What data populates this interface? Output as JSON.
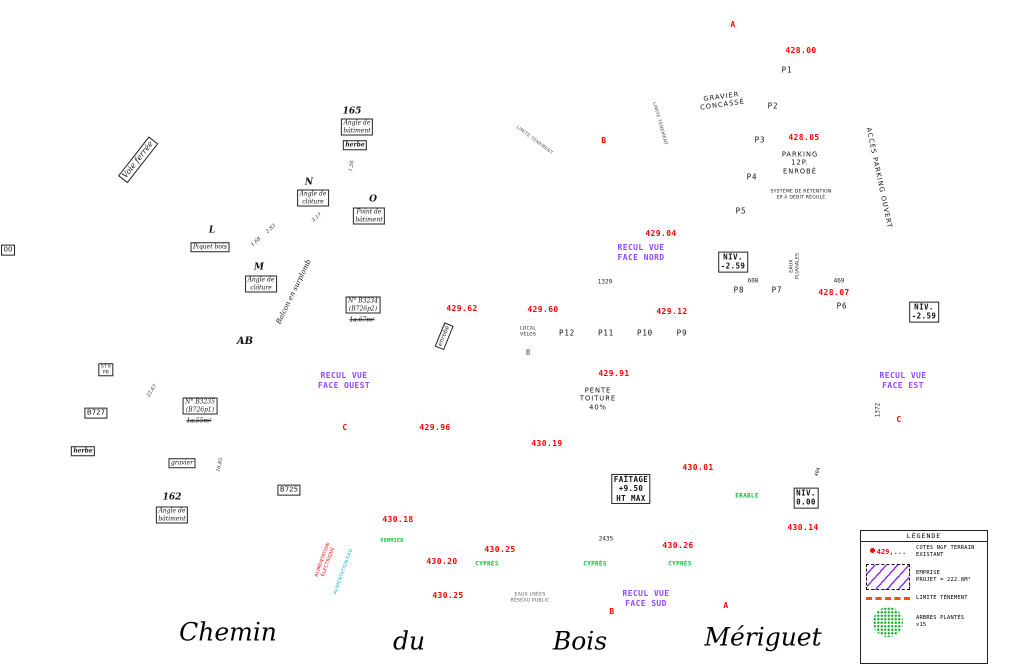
{
  "streets": {
    "chemin": "Chemin",
    "du": "du",
    "bois": "Bois",
    "meriguet": "Mériguet"
  },
  "legend": {
    "title": "LÉGENDE",
    "cote_sample": "429,...",
    "items": [
      {
        "text": "COTES NGF TERRAIN\nEXISTANT"
      },
      {
        "text": "EMPRISE\nPROJET = 222.8M²"
      },
      {
        "text": "LIMITE TÈNEMENT"
      },
      {
        "text": "ARBRES PLANTÉS\nx15"
      }
    ]
  },
  "building": {
    "ridge_label": "FAÎTAGE\n+9.50\nHT MAX",
    "slope_label": "PENTE\nTOITURE\n40%",
    "emprise_area": "222.8M²"
  },
  "elevations": [
    {
      "v": "428.00",
      "x": 801,
      "y": 51,
      "dx": 779,
      "dy": 51
    },
    {
      "v": "428.05",
      "x": 804,
      "y": 138,
      "dx": 781,
      "dy": 138
    },
    {
      "v": "429.04",
      "x": 661,
      "y": 234,
      "dx": 640,
      "dy": 234
    },
    {
      "v": "429.62",
      "x": 462,
      "y": 309,
      "dx": 482,
      "dy": 313
    },
    {
      "v": "429.60",
      "x": 543,
      "y": 310,
      "dx": 565,
      "dy": 313
    },
    {
      "v": "429.12",
      "x": 672,
      "y": 312,
      "dx": 695,
      "dy": 314
    },
    {
      "v": "428.07",
      "x": 834,
      "y": 293,
      "dx": 810,
      "dy": 294
    },
    {
      "v": "429.96",
      "x": 435,
      "y": 428,
      "dx": 453,
      "dy": 434
    },
    {
      "v": "429.91",
      "x": 614,
      "y": 374,
      "dx": 590,
      "dy": 375
    },
    {
      "v": "430.19",
      "x": 547,
      "y": 444,
      "dx": 524,
      "dy": 446
    },
    {
      "v": "430.01",
      "x": 698,
      "y": 468,
      "dx": 676,
      "dy": 470
    },
    {
      "v": "430.18",
      "x": 398,
      "y": 520,
      "dx": 374,
      "dy": 529
    },
    {
      "v": "430.14",
      "x": 803,
      "y": 528,
      "dx": 780,
      "dy": 530
    },
    {
      "v": "430.25",
      "x": 500,
      "y": 550,
      "dx": 478,
      "dy": 552
    },
    {
      "v": "430.20",
      "x": 442,
      "y": 562,
      "dx": 420,
      "dy": 564
    },
    {
      "v": "430.26",
      "x": 678,
      "y": 546,
      "dx": 661,
      "dy": 548
    },
    {
      "v": "430.25",
      "x": 448,
      "y": 596,
      "dx": 426,
      "dy": 598
    }
  ],
  "texts": [
    {
      "t": "A",
      "x": 733,
      "y": 25,
      "c": "red b9"
    },
    {
      "t": "A",
      "x": 726,
      "y": 606,
      "c": "red b9"
    },
    {
      "t": "B",
      "x": 604,
      "y": 141,
      "c": "red b9"
    },
    {
      "t": "B",
      "x": 612,
      "y": 612,
      "c": "red b9"
    },
    {
      "t": "C",
      "x": 345,
      "y": 428,
      "c": "red b9"
    },
    {
      "t": "C",
      "x": 899,
      "y": 420,
      "c": "red b9"
    },
    {
      "t": "P1",
      "x": 787,
      "y": 70,
      "c": "pk"
    },
    {
      "t": "P2",
      "x": 773,
      "y": 106,
      "c": "pk"
    },
    {
      "t": "P3",
      "x": 760,
      "y": 140,
      "c": "pk"
    },
    {
      "t": "P4",
      "x": 752,
      "y": 177,
      "c": "pk"
    },
    {
      "t": "P5",
      "x": 741,
      "y": 211,
      "c": "pk"
    },
    {
      "t": "P6",
      "x": 842,
      "y": 306,
      "c": "pk"
    },
    {
      "t": "P7",
      "x": 777,
      "y": 290,
      "c": "pk"
    },
    {
      "t": "P8",
      "x": 739,
      "y": 290,
      "c": "pk"
    },
    {
      "t": "P9",
      "x": 682,
      "y": 333,
      "c": "pk"
    },
    {
      "t": "P10",
      "x": 645,
      "y": 333,
      "c": "pk"
    },
    {
      "t": "P11",
      "x": 606,
      "y": 333,
      "c": "pk"
    },
    {
      "t": "P12",
      "x": 567,
      "y": 333,
      "c": "pk"
    },
    {
      "t": "GRAVIER\nCONCASSÉ",
      "x": 722,
      "y": 101,
      "c": "blk7 sp",
      "r": -8
    },
    {
      "t": "PARKING\n12P.\nENROBÉ",
      "x": 800,
      "y": 163,
      "c": "blk7 sp"
    },
    {
      "t": "SYSTÈME DE RÉTENTION\nEP À DÉBIT RÉGULÉ",
      "x": 801,
      "y": 195,
      "c": "tiny"
    },
    {
      "t": "EAUX\nPLUVIALES",
      "x": 795,
      "y": 266,
      "c": "tiny",
      "r": -90
    },
    {
      "t": "ACCÈS PARKING OUVERT",
      "x": 879,
      "y": 178,
      "c": "blk7 sp",
      "r": 78
    },
    {
      "t": "LIMITE TÈNEMENT",
      "x": 659,
      "y": 124,
      "c": "tiny gray",
      "r": 74
    },
    {
      "t": "LIMITE TÈNEMENT",
      "x": 534,
      "y": 141,
      "c": "tiny gray",
      "r": 37
    },
    {
      "t": "RECUL VUE\nFACE NORD",
      "x": 641,
      "y": 253,
      "c": "purple"
    },
    {
      "t": "RECUL VUE\nFACE OUEST",
      "x": 344,
      "y": 381,
      "c": "purple"
    },
    {
      "t": "RECUL VUE\nFACE EST",
      "x": 903,
      "y": 381,
      "c": "purple"
    },
    {
      "t": "RECUL VUE\nFACE SUD",
      "x": 646,
      "y": 599,
      "c": "purple"
    },
    {
      "t": "NIV.\n-2.59",
      "x": 733,
      "y": 262,
      "c": "box niv"
    },
    {
      "t": "NIV.\n-2.59",
      "x": 924,
      "y": 312,
      "c": "box niv"
    },
    {
      "t": "NIV.\n0.00",
      "x": 806,
      "y": 498,
      "c": "box niv"
    },
    {
      "t": "FAÎTAGE\n+9.50\nHT MAX",
      "x": 631,
      "y": 489,
      "c": "box niv"
    },
    {
      "t": "LOCAL\nVÉLOS",
      "x": 528,
      "y": 332,
      "c": "tiny"
    },
    {
      "t": "PENTE\nTOITURE\n40%",
      "x": 598,
      "y": 399,
      "c": "blk7 sp"
    },
    {
      "t": "1329",
      "x": 605,
      "y": 282,
      "c": "dim"
    },
    {
      "t": "608",
      "x": 753,
      "y": 281,
      "c": "dim"
    },
    {
      "t": "469",
      "x": 839,
      "y": 281,
      "c": "dim"
    },
    {
      "t": "1372",
      "x": 878,
      "y": 410,
      "c": "dim",
      "r": -90
    },
    {
      "t": "404",
      "x": 818,
      "y": 472,
      "c": "dim t5",
      "r": -72
    },
    {
      "t": "80",
      "x": 529,
      "y": 352,
      "c": "dim t5",
      "r": -90
    },
    {
      "t": "2435",
      "x": 606,
      "y": 539,
      "c": "dim"
    },
    {
      "t": "ÉRABLE",
      "x": 747,
      "y": 496,
      "c": "green"
    },
    {
      "t": "POMMIER",
      "x": 392,
      "y": 541,
      "c": "green t5"
    },
    {
      "t": "CYPRÈS",
      "x": 487,
      "y": 564,
      "c": "green"
    },
    {
      "t": "CYPRÈS",
      "x": 595,
      "y": 564,
      "c": "green"
    },
    {
      "t": "CYPRÈS",
      "x": 680,
      "y": 564,
      "c": "green"
    },
    {
      "t": "EAUX USÉES\nRÉSEAU PUBLIC",
      "x": 530,
      "y": 598,
      "c": "tiny gray"
    },
    {
      "t": "ALIMENTATION\nÉLECTRIQUE",
      "x": 326,
      "y": 561,
      "c": "tiny redc",
      "r": -70
    },
    {
      "t": "ALIMENTATION EAU",
      "x": 344,
      "y": 572,
      "c": "tiny cyanc",
      "r": -70
    },
    {
      "t": "Voie ferrée",
      "x": 138,
      "y": 160,
      "c": "box it b8",
      "r": -52
    },
    {
      "t": "165",
      "x": 352,
      "y": 112,
      "c": "it b9"
    },
    {
      "t": "Angle de\nbâtiment",
      "x": 357,
      "y": 127,
      "c": "box it"
    },
    {
      "t": "herbe",
      "x": 355,
      "y": 145,
      "c": "box it bold"
    },
    {
      "t": "N",
      "x": 309,
      "y": 183,
      "c": "it b9"
    },
    {
      "t": "Angle de\nclôture",
      "x": 313,
      "y": 198,
      "c": "box it"
    },
    {
      "t": "O",
      "x": 373,
      "y": 200,
      "c": "it b9"
    },
    {
      "t": "Point de\nbâtiment",
      "x": 369,
      "y": 216,
      "c": "box it"
    },
    {
      "t": "L",
      "x": 212,
      "y": 231,
      "c": "it b9"
    },
    {
      "t": "Piquet bois",
      "x": 210,
      "y": 247,
      "c": "box it"
    },
    {
      "t": "M",
      "x": 259,
      "y": 268,
      "c": "it b9"
    },
    {
      "t": "Angle de\nclôture",
      "x": 261,
      "y": 284,
      "c": "box it"
    },
    {
      "t": "1.68",
      "x": 256,
      "y": 242,
      "c": "it dim t5",
      "r": -42
    },
    {
      "t": "2.83",
      "x": 271,
      "y": 229,
      "c": "it dim t5",
      "r": -42
    },
    {
      "t": "3.17",
      "x": 317,
      "y": 218,
      "c": "it dim t5",
      "r": -38
    },
    {
      "t": "1.56",
      "x": 352,
      "y": 166,
      "c": "it dim t5",
      "r": -80
    },
    {
      "t": "Balcon en surplomb",
      "x": 294,
      "y": 292,
      "c": "it b7",
      "r": -64
    },
    {
      "t": "N° B3234\n(B726p2)",
      "x": 363,
      "y": 305,
      "c": "box it"
    },
    {
      "t": "1a.67m²",
      "x": 362,
      "y": 320,
      "c": "it strike"
    },
    {
      "t": "AB",
      "x": 245,
      "y": 342,
      "c": "it b10"
    },
    {
      "t": "enrobé",
      "x": 444,
      "y": 336,
      "c": "box it",
      "r": -68
    },
    {
      "t": "ST.6\nPB",
      "x": 106,
      "y": 370,
      "c": "box tiny"
    },
    {
      "t": "B727",
      "x": 96,
      "y": 413,
      "c": "box b7"
    },
    {
      "t": "herbe",
      "x": 83,
      "y": 451,
      "c": "box it bold"
    },
    {
      "t": "23.67",
      "x": 152,
      "y": 391,
      "c": "it dim t5",
      "r": -56
    },
    {
      "t": "N° B3235\n(B726p1)",
      "x": 200,
      "y": 406,
      "c": "box it"
    },
    {
      "t": "1a.55m²",
      "x": 199,
      "y": 421,
      "c": "it strike"
    },
    {
      "t": "gravier",
      "x": 182,
      "y": 463,
      "c": "box it"
    },
    {
      "t": "16.85",
      "x": 220,
      "y": 465,
      "c": "it dim t5",
      "r": -76
    },
    {
      "t": "B725",
      "x": 289,
      "y": 490,
      "c": "box b7"
    },
    {
      "t": "162",
      "x": 172,
      "y": 498,
      "c": "it b9"
    },
    {
      "t": "Angle de\nbâtiment",
      "x": 172,
      "y": 515,
      "c": "box it"
    },
    {
      "t": "00",
      "x": 8,
      "y": 250,
      "c": "box b7"
    }
  ],
  "trees": [
    [
      556,
      243,
      13
    ],
    [
      596,
      228,
      15
    ],
    [
      387,
      562,
      22
    ],
    [
      440,
      577,
      11
    ],
    [
      472,
      574,
      11
    ],
    [
      498,
      576,
      10
    ],
    [
      562,
      574,
      10
    ],
    [
      590,
      576,
      10
    ],
    [
      622,
      575,
      9
    ],
    [
      650,
      574,
      10
    ],
    [
      681,
      575,
      10
    ],
    [
      765,
      517,
      15
    ],
    [
      791,
      543,
      7
    ],
    [
      836,
      492,
      9
    ]
  ],
  "hedges": [
    [
      517,
      534,
      12,
      48
    ],
    [
      610,
      534,
      12,
      47
    ],
    [
      702,
      534,
      9,
      47
    ],
    [
      818,
      392,
      44,
      9
    ]
  ],
  "purple_triangles": [
    {
      "x": 647,
      "y": 277,
      "dir": "down"
    },
    {
      "x": 397,
      "y": 378,
      "dir": "right"
    },
    {
      "x": 857,
      "y": 379,
      "dir": "left"
    },
    {
      "x": 648,
      "y": 551,
      "dir": "up"
    }
  ],
  "parking_arrows": [
    {
      "x": 846,
      "y": 129,
      "rot": 205
    },
    {
      "x": 864,
      "y": 196,
      "rot": 200
    }
  ],
  "small_arrows": [
    {
      "x": 263,
      "y": 251,
      "rot": 140
    },
    {
      "x": 250,
      "y": 522,
      "rot": 140
    },
    {
      "x": 410,
      "y": 318,
      "rot": 140
    }
  ],
  "section_flags": [
    {
      "x": 745,
      "y": 26,
      "rot": 0
    },
    {
      "x": 738,
      "y": 606,
      "rot": 0
    },
    {
      "x": 592,
      "y": 141,
      "rot": 0
    },
    {
      "x": 596,
      "y": 612,
      "rot": 0
    },
    {
      "x": 345,
      "y": 443,
      "rot": 90
    },
    {
      "x": 899,
      "y": 434,
      "rot": 90
    }
  ]
}
